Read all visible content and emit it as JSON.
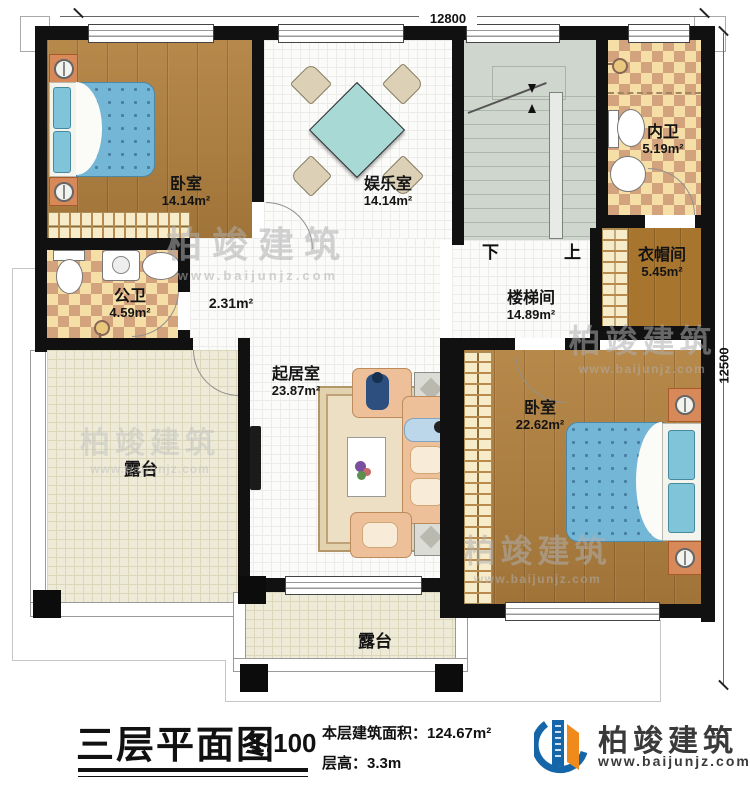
{
  "plan": {
    "dim_top": "12800",
    "dim_right": "12500",
    "stair_down": "下",
    "stair_up": "上",
    "rooms": {
      "bedroom_tl": {
        "name": "卧室",
        "area": "14.14m²"
      },
      "entertainment": {
        "name": "娱乐室",
        "area": "14.14m²"
      },
      "bath_inner": {
        "name": "内卫",
        "area": "5.19m²"
      },
      "cloakroom": {
        "name": "衣帽间",
        "area": "5.45m²"
      },
      "bath_public": {
        "name": "公卫",
        "area": "4.59m²"
      },
      "stairwell": {
        "name": "楼梯间",
        "area": "14.89m²"
      },
      "living": {
        "name": "起居室",
        "area": "23.87m²"
      },
      "bedroom_br": {
        "name": "卧室",
        "area": "22.62m²"
      },
      "terrace_left": {
        "name": "露台"
      },
      "terrace_bottom": {
        "name": "露台"
      },
      "corridor": {
        "area": "2.31m²"
      }
    },
    "titleblock": {
      "title": "三层平面图",
      "scale": "1:100",
      "area_line": "本层建筑面积：124.67m²",
      "height_line": "层高：3.3m"
    },
    "brand": {
      "name": "柏竣建筑",
      "website": "www.baijunjz.com"
    },
    "watermark": {
      "name": "柏竣建筑",
      "website": "www.baijunjz.com"
    },
    "colors": {
      "wall": "#111111",
      "wood_floor": "#b2813f",
      "tile_tan": "#d2a37d",
      "tile_cream": "#f6dfa6",
      "stair_floor": "#cfd6cd",
      "terrace_floor": "#edead8",
      "mattress_blue": "#74b6d5",
      "sofa_peach": "#eec09a",
      "table_teal": "#a9d9d5",
      "brand_blue": "#1566a8",
      "brand_orange": "#ef8a1b"
    }
  }
}
